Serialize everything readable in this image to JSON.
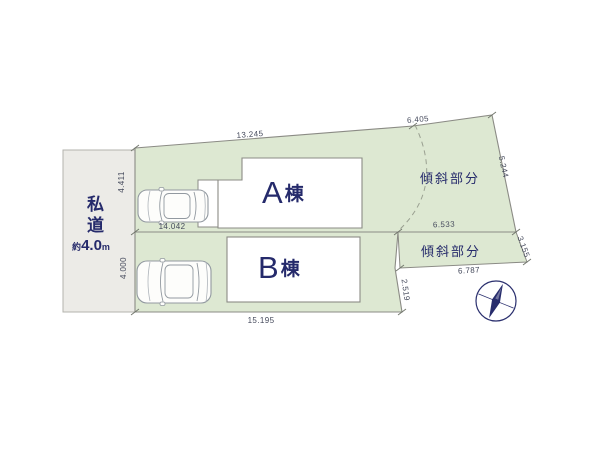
{
  "diagram": {
    "type": "site-plan",
    "road": {
      "name": "私道",
      "width_label_prefix": "約",
      "width_value": "4.0",
      "width_unit": "m"
    },
    "buildings": [
      {
        "id": "A",
        "letter": "A",
        "suffix": "棟"
      },
      {
        "id": "B",
        "letter": "B",
        "suffix": "棟"
      }
    ],
    "slope_areas": [
      {
        "label": "傾斜部分"
      },
      {
        "label": "傾斜部分"
      }
    ],
    "dimensions": {
      "top_main": "13.245",
      "top_right": "6.405",
      "right_upper": "5.244",
      "right_middle": "3.155",
      "divider": "14.042",
      "slope_strip_top": "6.533",
      "slope_strip_bottom": "6.787",
      "parcel_b_right": "2.519",
      "bottom": "15.195",
      "parcel_a_left": "4.411",
      "parcel_b_left": "4.000"
    },
    "icons": {
      "compass": "compass-north-needle",
      "cars": 2
    },
    "colors": {
      "parcel_fill": "#dde8d2",
      "road_fill": "#ecebe7",
      "outline_gray": "#8b8b85",
      "label_navy": "#252a6b",
      "dimension_text": "#454a5c",
      "background": "#ffffff"
    }
  }
}
